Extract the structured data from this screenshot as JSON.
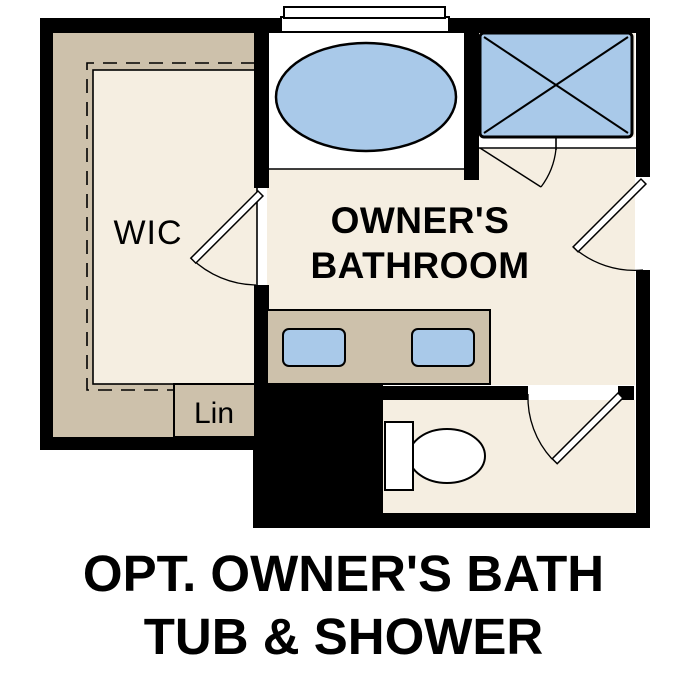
{
  "title": {
    "line1": "OPT. OWNER'S BATH",
    "line2": "TUB & SHOWER"
  },
  "rooms": {
    "wic": {
      "label": "WIC"
    },
    "bathroom": {
      "label_line1": "OWNER'S",
      "label_line2": "BATHROOM"
    },
    "linen": {
      "label": "Lin"
    }
  },
  "fixtures": {
    "bathtub": "oval-tub-icon",
    "shower": "shower-pan-x-icon",
    "vanity": "double-sink-vanity-icon",
    "toilet": "toilet-icon",
    "window": "window-icon",
    "doors": [
      "wic-door",
      "bathroom-entry-door",
      "water-closet-door",
      "shower-door"
    ]
  },
  "colors": {
    "wall": "#000000",
    "floor": "#f5eee1",
    "cabinet": "#cdc1ab",
    "fixture_blue": "#a9c9e9",
    "text": "#000000",
    "background": "#ffffff"
  }
}
